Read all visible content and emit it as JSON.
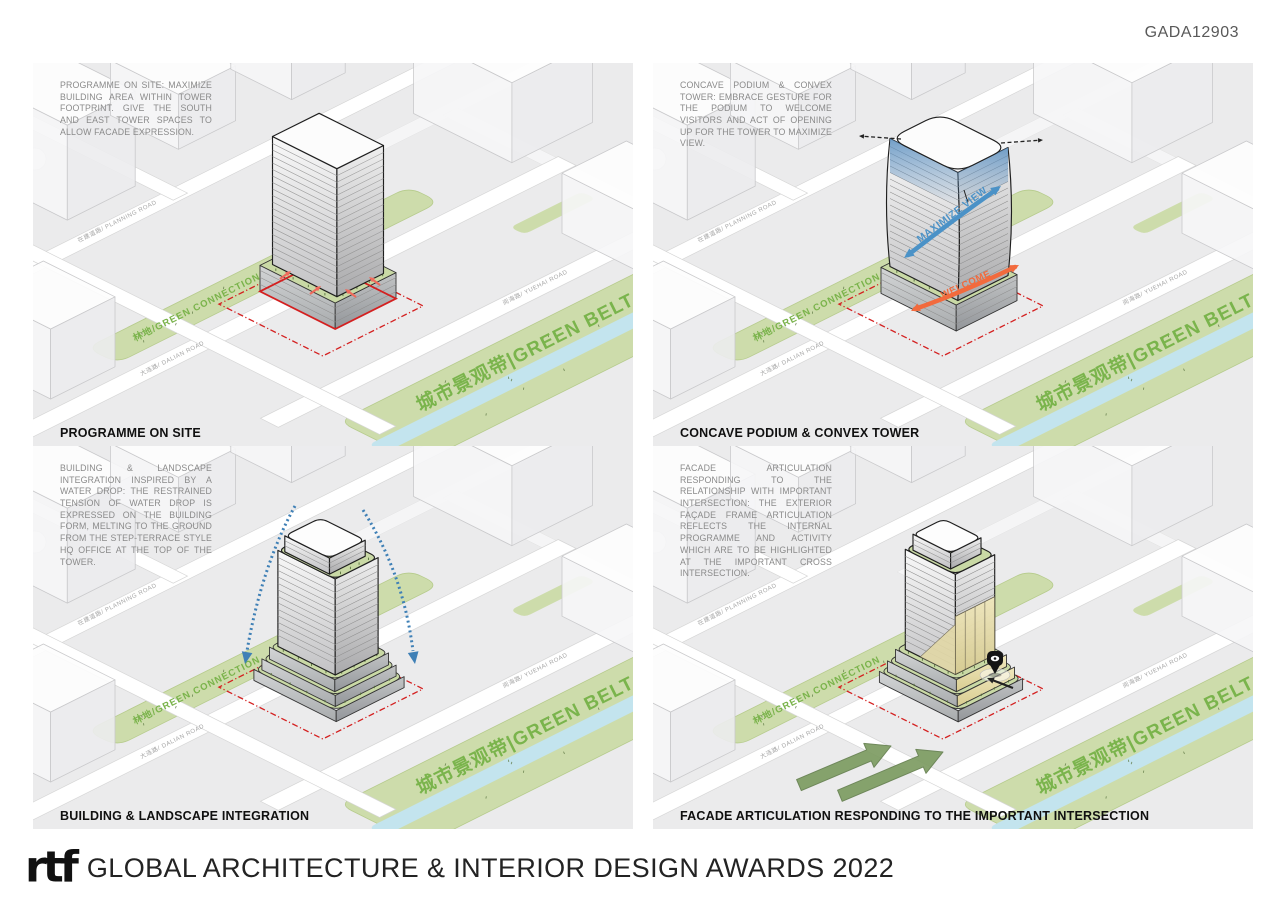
{
  "header": {
    "code": "GADA12903"
  },
  "footer": {
    "logo_text": "rtf",
    "title": "GLOBAL ARCHITECTURE & INTERIOR DESIGN AWARDS 2022"
  },
  "map_labels": {
    "planning_road": "在建道路/ PLANNING ROAD",
    "dalian_road": "大连路/ DALIAN ROAD",
    "yuehai_road": "阅海路/ YUEHAI ROAD",
    "green_connection": "林地/GREEN CONNECTION",
    "green_belt": "城市景观带|GREEN BELT"
  },
  "panels": [
    {
      "id": "programme-on-site",
      "title": "PROGRAMME ON SITE",
      "description": "PROGRAMME ON SITE: MAXIMIZE BUILDING AREA WITHIN TOWER FOOTPRINT. GIVE THE SOUTH AND EAST TOWER SPACES TO ALLOW FACADE EXPRESSION."
    },
    {
      "id": "concave-podium-convex-tower",
      "title": "CONCAVE PODIUM & CONVEX TOWER",
      "description": "CONCAVE PODIUM & CONVEX TOWER: EMBRACE GESTURE FOR THE PODIUM TO WELCOME VISITORS AND ACT OF OPENING UP FOR THE TOWER TO MAXIMIZE VIEW.",
      "annotations": {
        "maximize_view": "MAXIMIZE VIEW",
        "welcome": "WELCOME"
      }
    },
    {
      "id": "building-landscape-integration",
      "title": "BUILDING & LANDSCAPE INTEGRATION",
      "description": "BUILDING & LANDSCAPE INTEGRATION INSPIRED BY A WATER DROP: THE RESTRAINED TENSION OF WATER DROP IS EXPRESSED ON THE BUILDING FORM, MELTING TO THE GROUND FROM THE STEP-TERRACE STYLE HQ OFFICE AT THE TOP OF THE TOWER."
    },
    {
      "id": "facade-articulation",
      "title": "FACADE ARTICULATION RESPONDING TO THE IMPORTANT INTERSECTION",
      "description": "FACADE ARTICULATION RESPONDING TO THE RELATIONSHIP WITH IMPORTANT INTERSECTION: THE EXTERIOR FAÇADE FRAME ARTICULATION REFLECTS THE INTERNAL PROGRAMME AND ACTIVITY WHICH ARE TO BE HIGHLIGHTED AT THE IMPORTANT CROSS INTERSECTION."
    }
  ],
  "colors": {
    "panel_background": "#ebebec",
    "green_area": "#cddcab",
    "green_text": "#7ab44c",
    "river": "#c3e4ee",
    "site_boundary_red": "#d42020",
    "view_arrow_blue": "#4b92c7",
    "welcome_arrow_orange": "#f26a3d",
    "facade_cream": "#e9e0ae",
    "intersection_arrow_green": "#7d9c62"
  }
}
